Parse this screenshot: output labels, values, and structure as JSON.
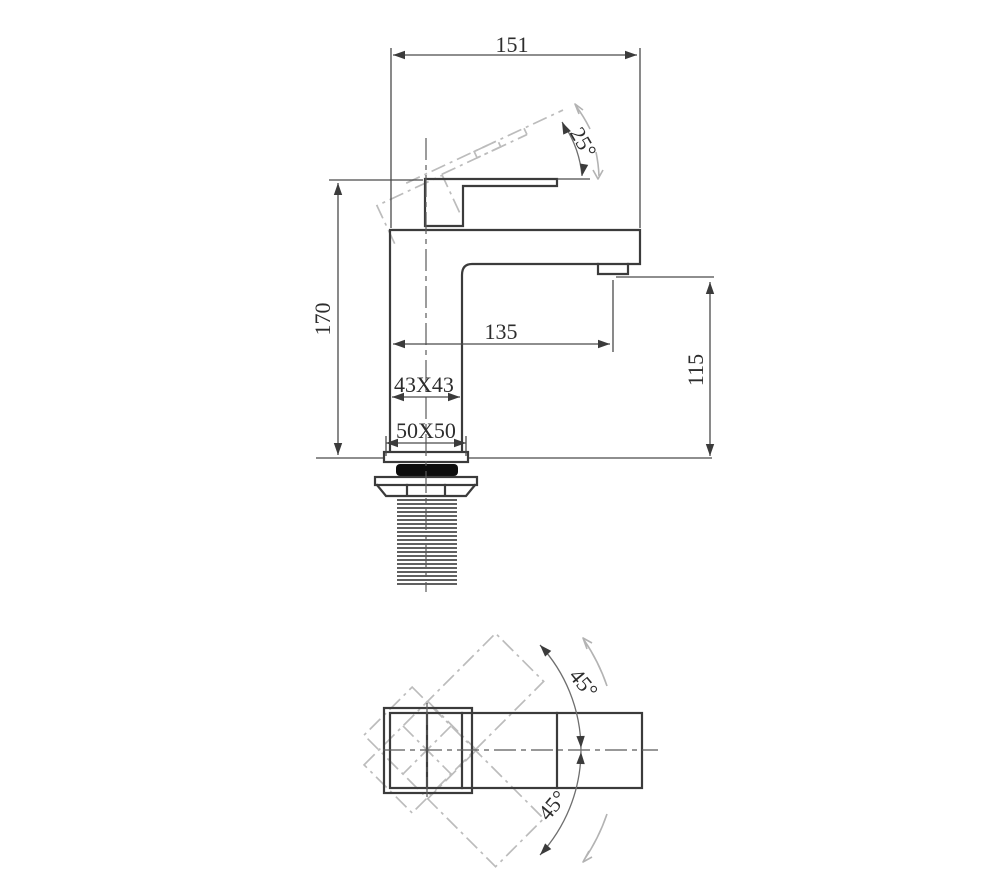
{
  "drawing": {
    "background": "#ffffff",
    "line_color": "#3b3b3b",
    "phantom_color": "#bcbcbc",
    "views": {
      "side": {
        "dims": {
          "overall_width": "151",
          "handle_tilt": "25°",
          "overall_height": "170",
          "spout_reach": "135",
          "spout_height": "115",
          "body_section": "43X43",
          "base_plate": "50X50"
        }
      },
      "top": {
        "dims": {
          "handle_swing_up": "45°",
          "handle_swing_down": "45°"
        }
      }
    }
  }
}
